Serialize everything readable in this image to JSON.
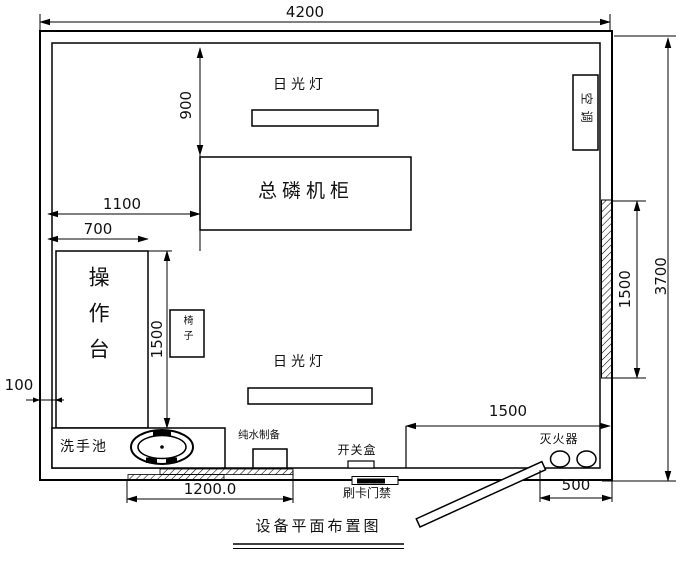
{
  "title": "设备平面布置图",
  "dims": {
    "overall_width": "4200",
    "overall_height": "3700",
    "lamp_top_offset": "900",
    "cabinet_offset": "1100",
    "console_width": "700",
    "console_length": "1500",
    "console_gap": "100",
    "bottom_window": "1200.0",
    "door_zone": "1500",
    "door_width": "500",
    "side_window": "1500"
  },
  "labels": {
    "lamp_top": "日光灯",
    "lamp_bottom": "日光灯",
    "cabinet": "总磷机柜",
    "aircon": "空调",
    "console": "操作台",
    "chair": "椅子",
    "sink": "洗手池",
    "pure_water": "纯水制备",
    "switch_box": "开关盒",
    "card_reader": "刷卡门禁",
    "extinguisher": "灭火器"
  },
  "colors": {
    "line": "#000000",
    "background": "#ffffff",
    "text": "#111111"
  }
}
